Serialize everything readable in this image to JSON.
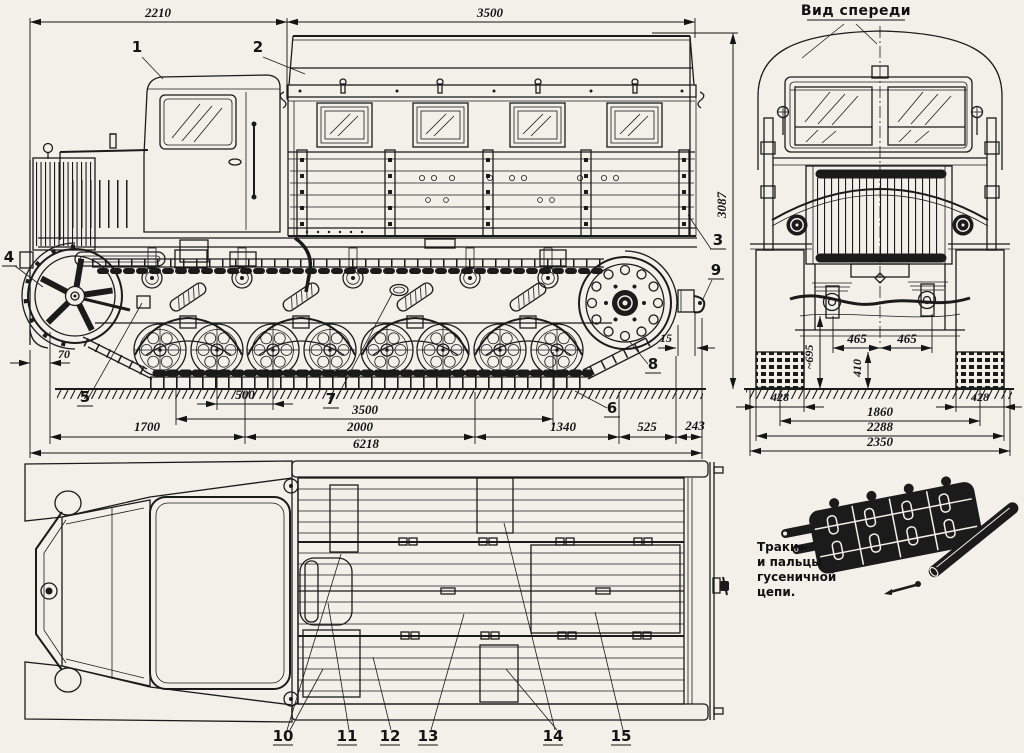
{
  "page": {
    "background": "#f2f0e9",
    "ink": "#1b1b1b"
  },
  "side_view": {
    "dims": {
      "front_length": "2210",
      "body_length": "3500",
      "overall_height": "3087",
      "front_overhang": "70",
      "sprocket_gap": "15",
      "wheel_pitch": "500",
      "ground_contact": "3500",
      "front_section": "1700",
      "mid_section": "2000",
      "rear_section": "1340",
      "rear_overhang": "525",
      "hook_overhang": "243",
      "overall_length": "6218"
    },
    "callouts": {
      "c1": "1",
      "c2": "2",
      "c3": "3",
      "c4": "4",
      "c5": "5",
      "c6": "6",
      "c7": "7",
      "c8": "8",
      "c9": "9"
    }
  },
  "front_view": {
    "title": "Вид спереди",
    "dims": {
      "axle_left": "465",
      "axle_right": "465",
      "clearance": "410",
      "belly_height": "~695",
      "track_width_left": "428",
      "track_width_right": "428",
      "track_centers": "1860",
      "body_width": "2288",
      "overall_width": "2350"
    }
  },
  "top_view": {
    "callouts": {
      "c10": "10",
      "c11": "11",
      "c12": "12",
      "c13": "13",
      "c14": "14",
      "c15": "15"
    }
  },
  "track_detail": {
    "pointer": "►",
    "caption_lines": {
      "l1": "Траки",
      "l2": "и пальцы",
      "l3": "гусеничной",
      "l4": "цепи."
    }
  }
}
